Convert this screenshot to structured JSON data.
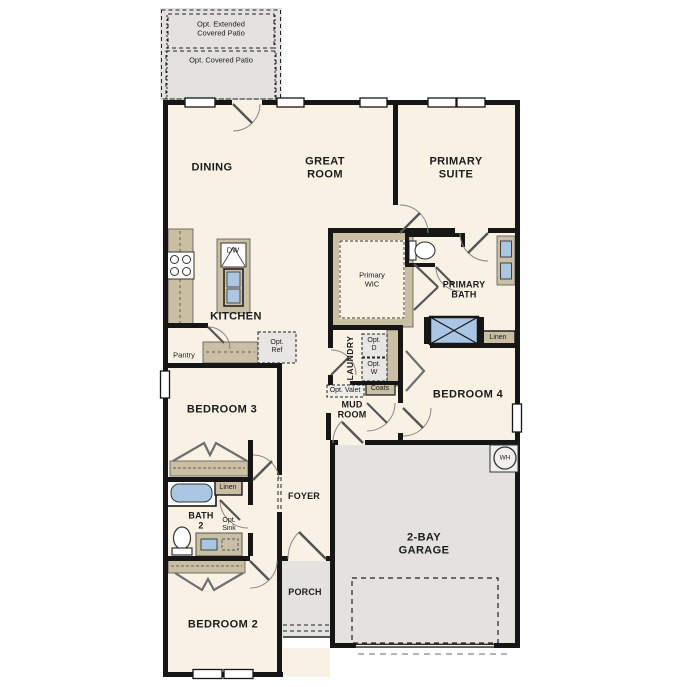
{
  "labels": {
    "opt_extended_patio": "Opt. Extended\nCovered Patio",
    "opt_covered_patio": "Opt. Covered Patio",
    "dining": "DINING",
    "great_room": "GREAT\nROOM",
    "primary_suite": "PRIMARY\nSUITE",
    "kitchen": "KITCHEN",
    "dw": "DW",
    "pantry": "Pantry",
    "opt_ref": "Opt.\nRef",
    "primary_wic": "Primary\nWIC",
    "primary_bath": "PRIMARY\nBATH",
    "linen_primary": "Linen",
    "laundry": "LAUNDRY",
    "opt_d": "Opt.\nD",
    "opt_w": "Opt.\nW",
    "opt_valet": "Opt. Valet",
    "coats": "Coats",
    "mud_room": "MUD\nROOM",
    "bedroom_4": "BEDROOM 4",
    "bedroom_3": "BEDROOM 3",
    "linen_bath2": "Linen",
    "bath_2": "BATH\n2",
    "opt_sink": "Opt.\nSink",
    "foyer": "FOYER",
    "porch": "PORCH",
    "bedroom_2": "BEDROOM 2",
    "garage": "2-BAY\nGARAGE",
    "wh": "WH"
  },
  "colors": {
    "interior": "#f8f1e4",
    "exterior_concrete": "#e3e2de",
    "cabinet_tan": "#cbbfa3",
    "fixture_blue": "#a9c6e2",
    "wall": "#161616",
    "background": "#ffffff"
  }
}
